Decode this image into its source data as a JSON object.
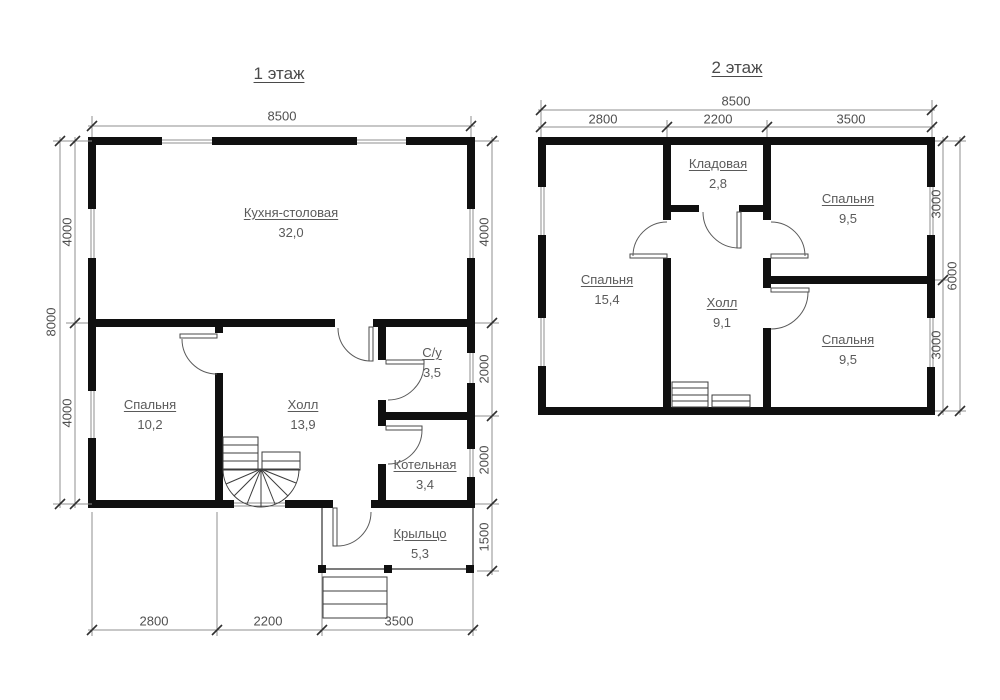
{
  "colors": {
    "wall": "#101010",
    "text": "#5a5a5a",
    "dim_line": "#8f8f8f"
  },
  "floor1": {
    "title": "1 этаж",
    "rooms": {
      "kitchen": {
        "name": "Кухня-столовая",
        "area": "32,0"
      },
      "bedroom": {
        "name": "Спальня",
        "area": "10,2"
      },
      "hall": {
        "name": "Холл",
        "area": "13,9"
      },
      "wc": {
        "name": "С/у",
        "area": "3,5"
      },
      "boiler": {
        "name": "Котельная",
        "area": "3,4"
      },
      "porch": {
        "name": "Крыльцо",
        "area": "5,3"
      }
    },
    "dims": {
      "top": "8500",
      "left_total": "8000",
      "left_top": "4000",
      "left_bottom": "4000",
      "right_top": "4000",
      "right_mid_upper": "2000",
      "right_mid_lower": "2000",
      "right_porch": "1500",
      "bottom_left": "2800",
      "bottom_center": "2200",
      "bottom_right": "3500"
    }
  },
  "floor2": {
    "title": "2 этаж",
    "rooms": {
      "storage": {
        "name": "Кладовая",
        "area": "2,8"
      },
      "bedroom_left": {
        "name": "Спальня",
        "area": "15,4"
      },
      "hall": {
        "name": "Холл",
        "area": "9,1"
      },
      "bedroom_top_right": {
        "name": "Спальня",
        "area": "9,5"
      },
      "bedroom_bottom_right": {
        "name": "Спальня",
        "area": "9,5"
      }
    },
    "dims": {
      "top_total": "8500",
      "top_left": "2800",
      "top_center": "2200",
      "top_right": "3500",
      "right_total": "6000",
      "right_top": "3000",
      "right_bottom": "3000"
    }
  }
}
